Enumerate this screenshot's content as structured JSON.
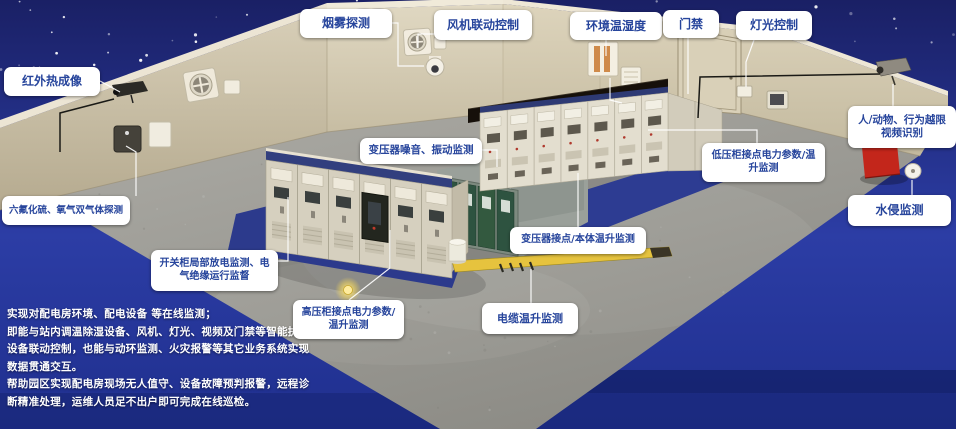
{
  "callouts": {
    "smoke": "烟雾探测",
    "fan_control": "风机联动控制",
    "env_temp_humidity": "环境温湿度",
    "door_access": "门禁",
    "light_control": "灯光控制",
    "infrared_thermal": "红外热成像",
    "video_recognition": "人/动物、行为越限视频识别",
    "gas_detection": "六氟化硫、氧气双气体探测",
    "water_intrusion": "水侵监测",
    "transformer_noise": "变压器噪音、振动监测",
    "lv_cabinet_monitor": "低压柜接点电力参数/温升监测",
    "transformer_temp": "变压器接点/本体温升监测",
    "switchgear_pd": "开关柜局部放电监测、电气绝缘运行监督",
    "hv_cabinet_monitor": "高压柜接点电力参数/温升监测",
    "cable_temp": "电缆温升监测"
  },
  "description": {
    "lines": [
      "实现对配电房环境、配电设备 等在线监测；",
      "即能与站内调温除湿设备、风机、灯光、视频及门禁等智能执行",
      "设备联动控制，也能与动环监测、火灾报警等其它业务系统实现",
      "数据贯通交互。",
      "帮助园区实现配电房现场无人值守、设备故障预判报警，远程诊",
      "断精准处理，运维人员足不出户即可完成在线巡检。"
    ]
  },
  "colors": {
    "sky_blue": "#232e86",
    "label_text_blue": "#27459c",
    "mat_blue": "#2c3a8c",
    "wall_beige": "#cfc5ab",
    "floor_gray": "#9c9b96",
    "transformer_green": "#2e5340",
    "duct_yellow": "#e3c43c",
    "alarm_red": "#c0251c"
  }
}
